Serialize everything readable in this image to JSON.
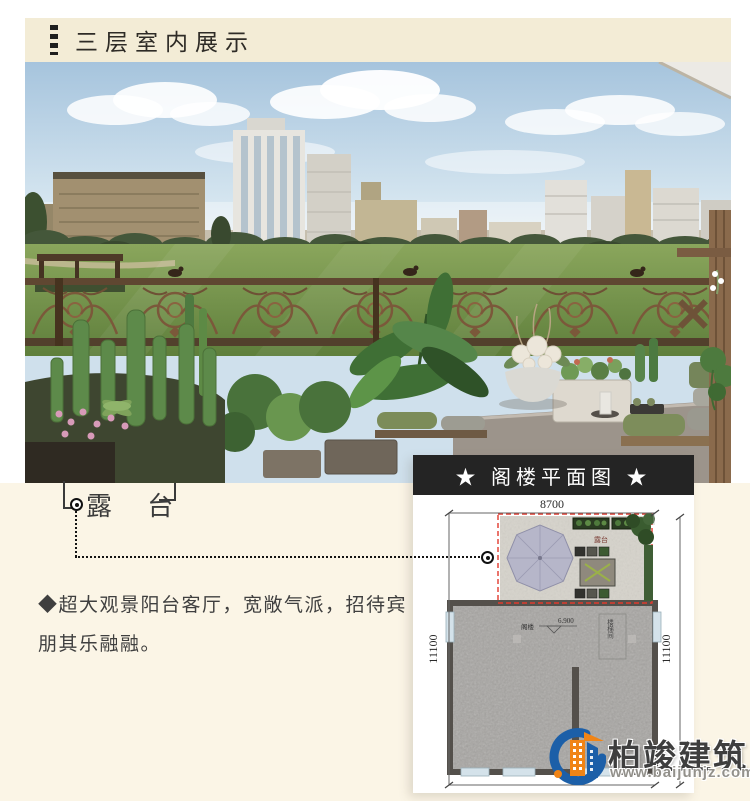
{
  "header": {
    "title": "三层室内展示"
  },
  "annotation": {
    "label": "露 台"
  },
  "description": {
    "text": "◆超大观景阳台客厅，宽敞气派，招待宾朋其乐融融。"
  },
  "floorplan": {
    "title": "★ 阁楼平面图 ★",
    "width_dim": "8700",
    "height_dim_left": "11100",
    "height_dim_right": "11100",
    "terrace_label": "露台",
    "room_label": "阁楼",
    "level_label": "6.900",
    "stair_label": "楼梯间"
  },
  "watermark": {
    "brand": "柏竣建筑",
    "website": "www.baijunjz.com"
  },
  "colors": {
    "header_bg": "#f3ecd6",
    "page_bottom_bg": "#fbf5e6",
    "plan_title_bg": "#242424",
    "accent_red": "#e03a2e",
    "brand_blue": "#1c5fa8",
    "brand_orange": "#f08416"
  }
}
